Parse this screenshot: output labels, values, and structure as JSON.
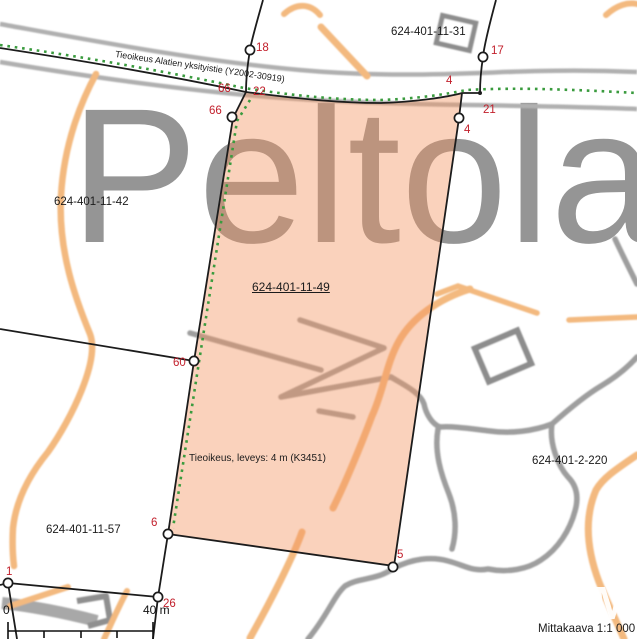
{
  "map": {
    "place_name": "Peltola",
    "watermark": "M",
    "road_label": "Tieoikeus Alatien yksityistie (Y2002-30919)",
    "easement_label": "Tieoikeus, leveys: 4 m (K3451)",
    "scale_caption": "Mittakaava 1:1 000",
    "scale_bar": {
      "start": "0",
      "end": "40 m"
    },
    "parcels": {
      "selected": "624-401-11-49",
      "p31": "624-401-11-31",
      "p42": "624-401-11-42",
      "p57": "624-401-11-57",
      "p220": "624-401-2-220"
    },
    "boundary_points": {
      "p18": "18",
      "p17": "17",
      "p66a": "66",
      "p22": "22",
      "p66b": "66",
      "p4a": "4",
      "p21": "21",
      "p4b": "4",
      "p60": "60",
      "p6": "6",
      "p5": "5",
      "p1": "1",
      "p26": "26"
    },
    "colors": {
      "selection_fill": "#F4945F",
      "boundary_black": "#1C1C1C",
      "point_label_red": "#C2202C",
      "easement_green": "#3A9B3E",
      "contour_orange": "#F3B97F",
      "road_gray": "#B0B0B0",
      "place_name_gray": "#959595"
    }
  }
}
